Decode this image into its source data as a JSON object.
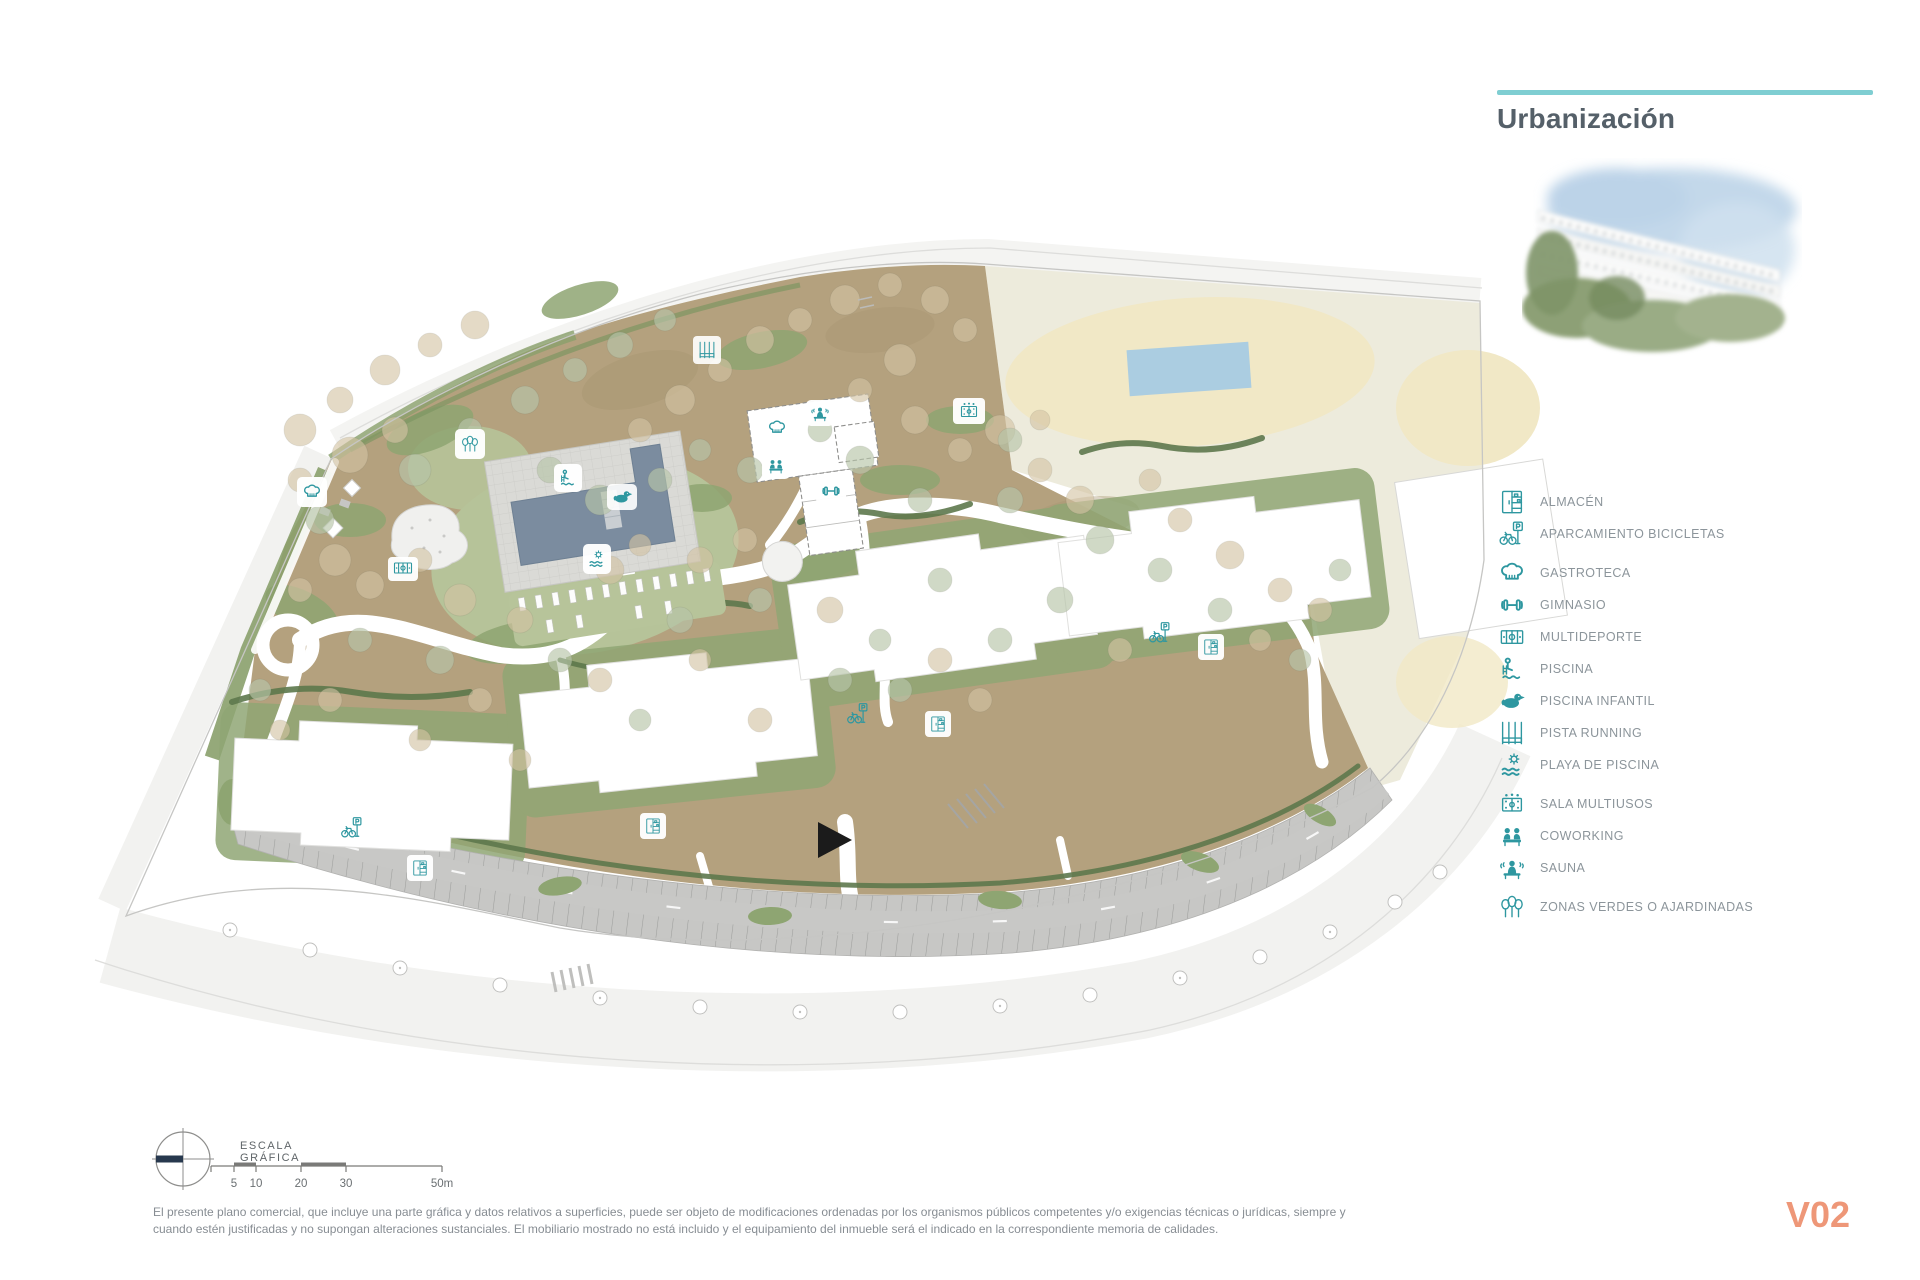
{
  "sidebar": {
    "title": "Urbanización",
    "accent_color": "#7fced2",
    "legend": {
      "items": [
        {
          "icon": "storage-icon",
          "label": "ALMACÉN"
        },
        {
          "icon": "bike-parking-icon",
          "label": "APARCAMIENTO BICICLETAS"
        },
        {
          "icon": "chef-hat-icon",
          "label": "GASTROTECA"
        },
        {
          "icon": "dumbbell-icon",
          "label": "GIMNASIO"
        },
        {
          "icon": "sports-court-icon",
          "label": "MULTIDEPORTE"
        },
        {
          "icon": "pool-icon",
          "label": "PISCINA"
        },
        {
          "icon": "duck-float-icon",
          "label": "PISCINA INFANTIL"
        },
        {
          "icon": "running-track-icon",
          "label": "PISTA RUNNING"
        },
        {
          "icon": "sun-waves-icon",
          "label": "PLAYA DE PISCINA"
        },
        {
          "icon": "multiuse-room-icon",
          "label": "SALA MULTIUSOS"
        },
        {
          "icon": "coworking-icon",
          "label": "COWORKING"
        },
        {
          "icon": "sauna-icon",
          "label": "SAUNA"
        },
        {
          "icon": "trees-icon",
          "label": "ZONAS VERDES O AJARDINADAS"
        }
      ]
    }
  },
  "scale_bar": {
    "title": "ESCALA GRÁFICA",
    "ticks": [
      "5",
      "10",
      "20",
      "30",
      "50m"
    ]
  },
  "footer": {
    "disclaimer_line1": "El presente plano comercial, que incluye una parte gráfica y datos relativos a superficies, puede ser objeto de modificaciones ordenadas por los organismos públicos competentes y/o exigencias técnicas o jurídicas, siempre y",
    "disclaimer_line2": "cuando estén justificadas y no supongan alteraciones sustanciales. El mobiliario mostrado no está incluido y el equipamiento del inmueble será el indicado en la correspondiente memoria de calidades.",
    "version": "V02",
    "version_color": "#ee9778"
  },
  "map": {
    "visible_amenity_markers": [
      "gastroteca",
      "multideporte",
      "zonas-verdes",
      "pista-running",
      "gastroteca",
      "sauna",
      "coworking",
      "gimnasio",
      "sala-multiusos",
      "piscina",
      "piscina-infantil",
      "playa-de-piscina",
      "aparcamiento-bicicletas",
      "aparcamiento-bicicletas",
      "aparcamiento-bicicletas",
      "almacén",
      "almacén",
      "almacén",
      "almacén"
    ],
    "colors": {
      "ground_tan": "#b4a17e",
      "green": "#8fa674",
      "hedge_dark": "#5d784c",
      "parking_gray": "#c7c7c5",
      "pool_water": "#7b8c9f",
      "neighbor_cream": "#edebdc",
      "sand": "#f1e8c6",
      "neighbor_pool_blue": "#abcde1",
      "icon_teal": "#2e97a0"
    }
  }
}
